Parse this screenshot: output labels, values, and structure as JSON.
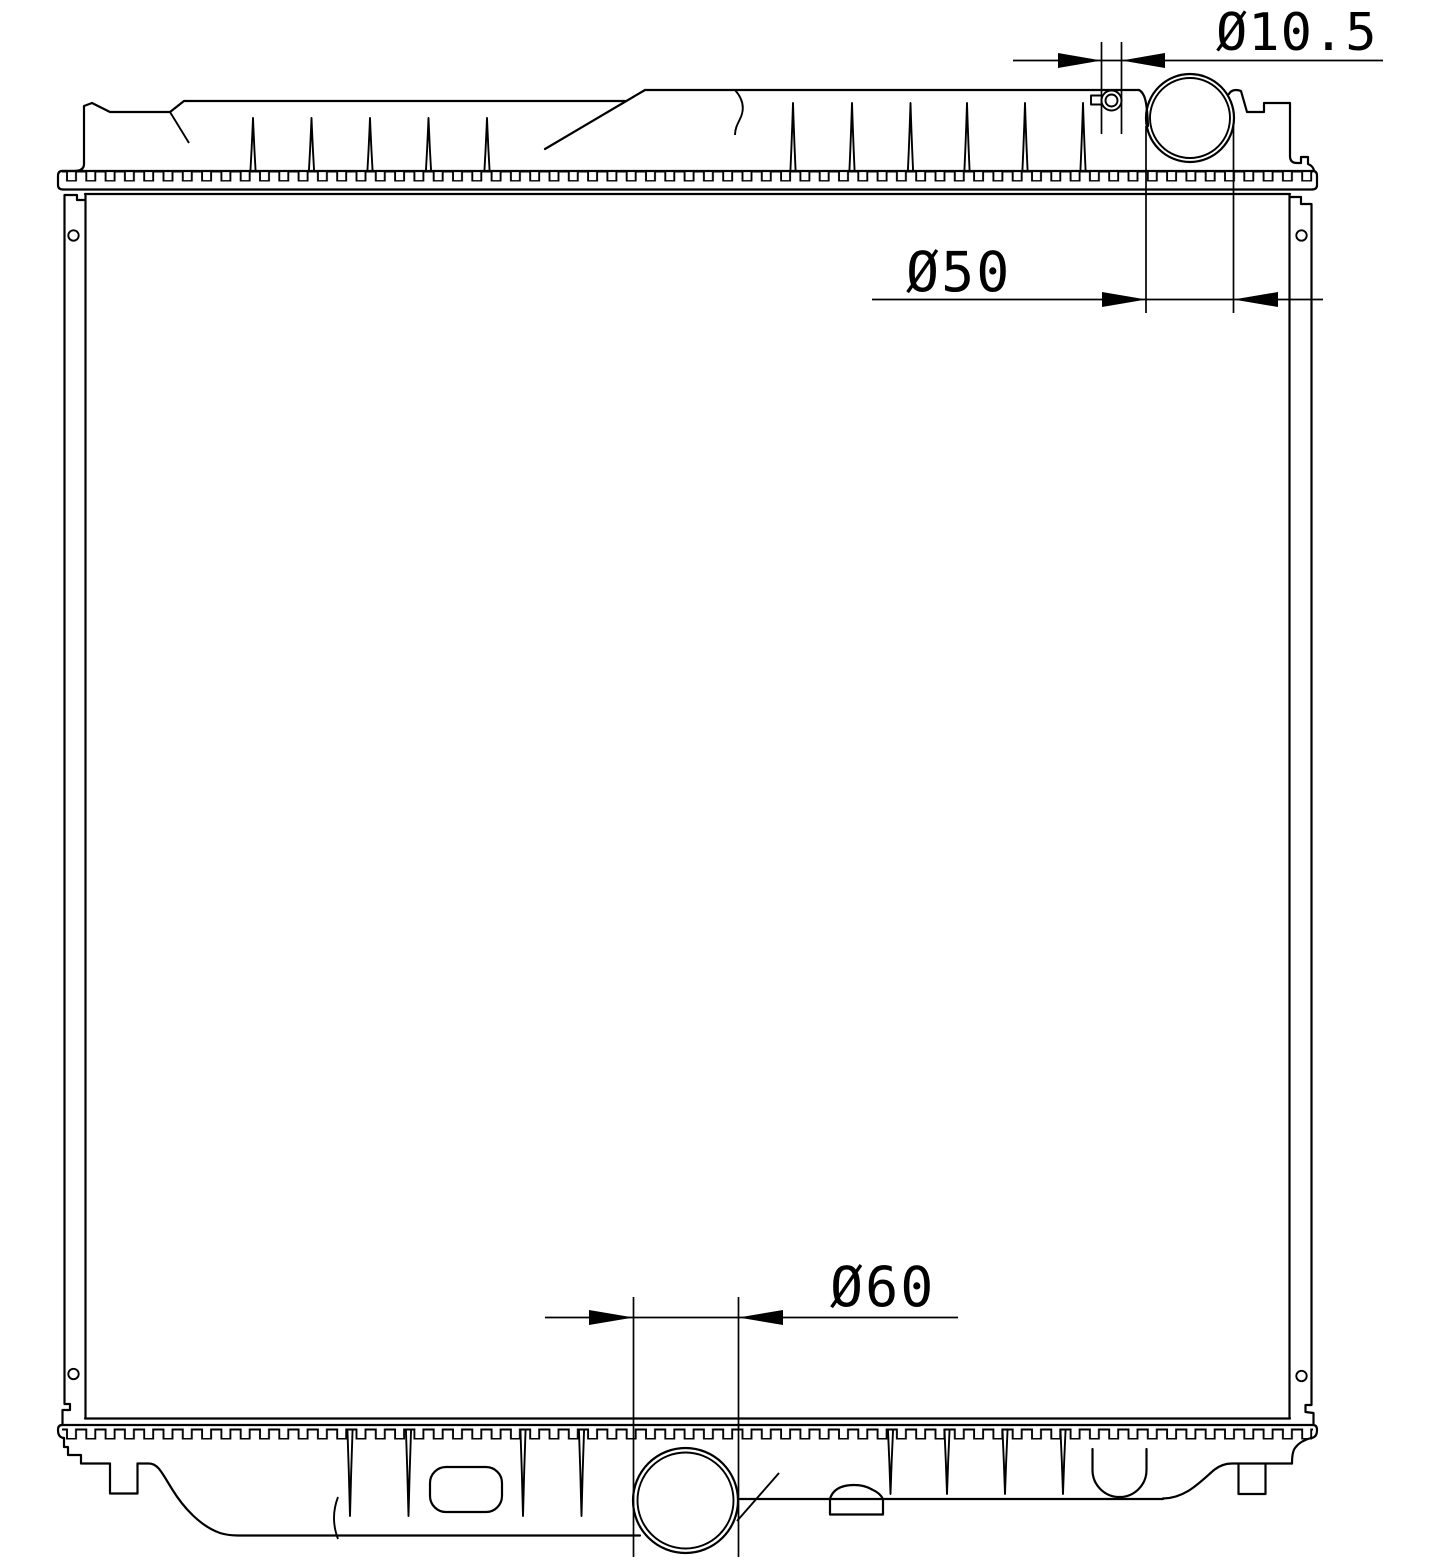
{
  "document": {
    "type": "technical-line-drawing",
    "subject": "radiator-front-elevation"
  },
  "colors": {
    "line": "#000000",
    "background": "#ffffff"
  },
  "dimensions": {
    "overflow_hole": {
      "label": "Ø10.5"
    },
    "filler_neck": {
      "label": "Ø50"
    },
    "outlet_port": {
      "label": "Ø60"
    }
  }
}
